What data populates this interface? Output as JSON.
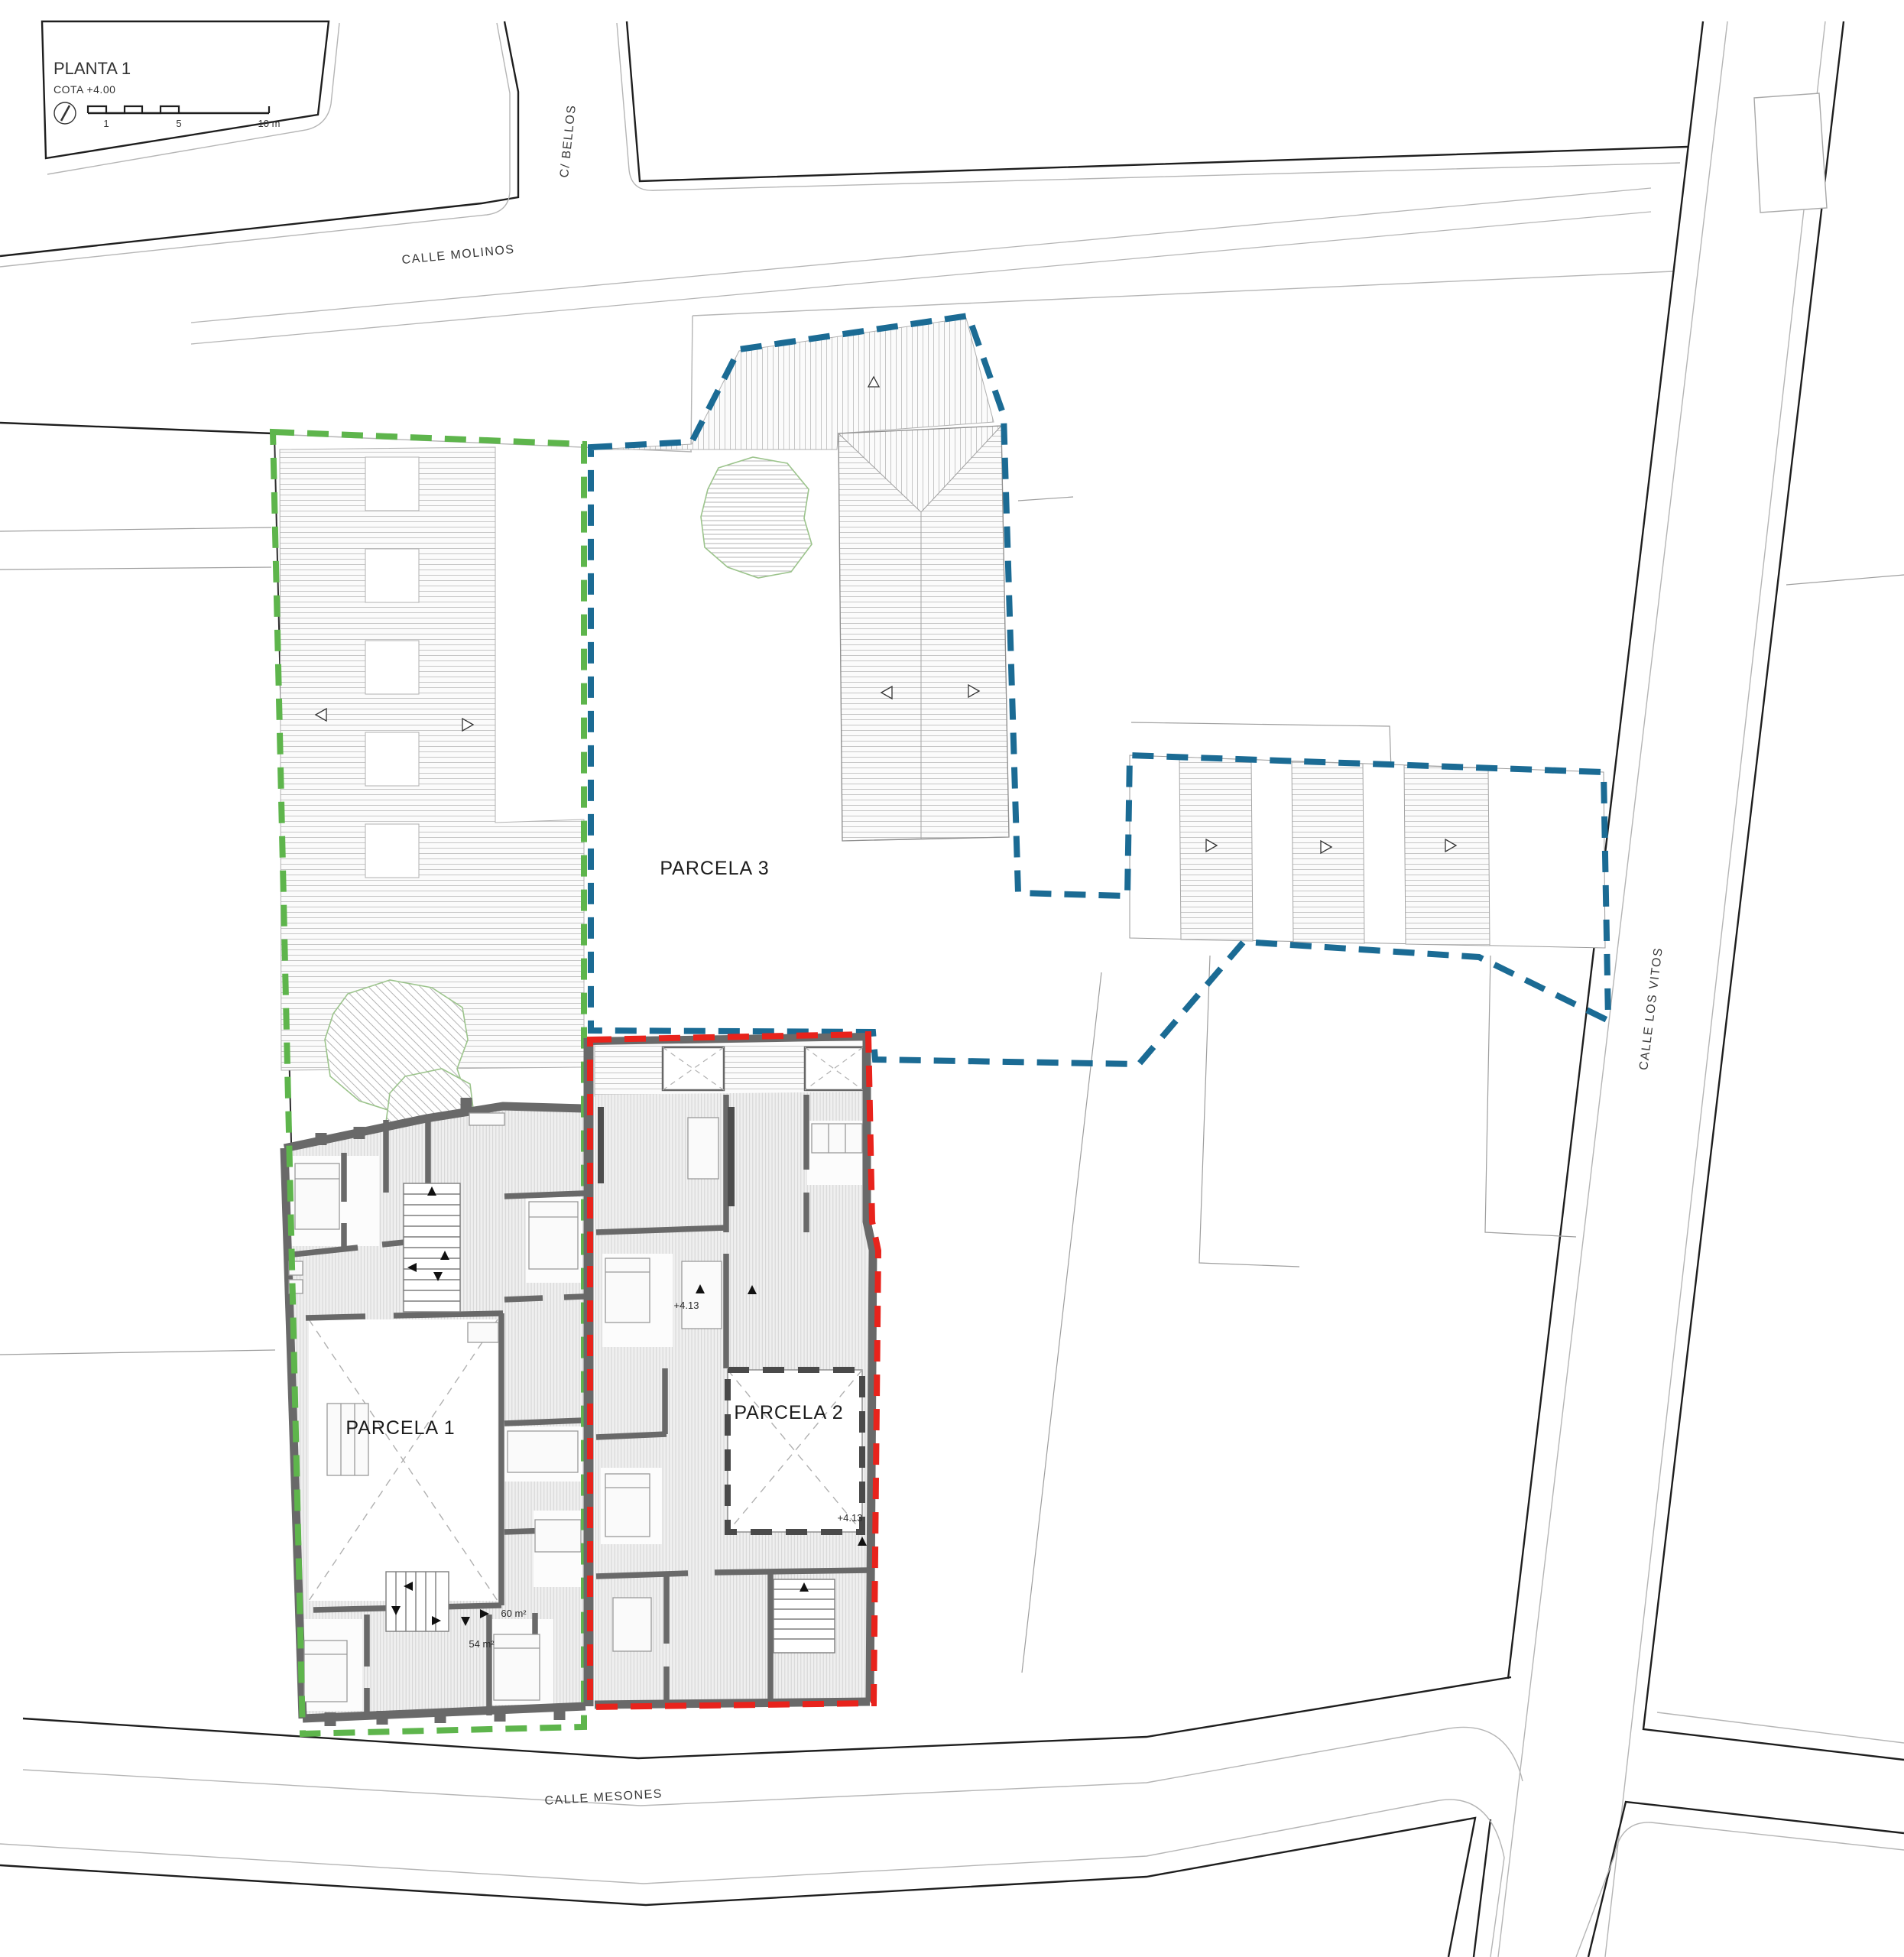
{
  "title": {
    "name": "PLANTA 1",
    "cota": "COTA +4.00"
  },
  "scale_bar": {
    "tick_1": "1",
    "tick_5": "5",
    "tick_10": "10 m"
  },
  "streets": {
    "molinos": "CALLE MOLINOS",
    "bellos": "C/ BELLOS",
    "los_vitos": "CALLE LOS VITOS",
    "mesones": "CALLE MESONES"
  },
  "parcels": {
    "parcela1": {
      "label": "PARCELA 1",
      "boundary_color": "#5eb54c"
    },
    "parcela2": {
      "label": "PARCELA 2",
      "boundary_color": "#e8231c"
    },
    "parcela3": {
      "label": "PARCELA 3",
      "boundary_color": "#1b6b94"
    }
  },
  "annotations": {
    "level_mark_a": "+4.13",
    "level_mark_b": "+4.13",
    "area_60": "60 m²",
    "area_54": "54 m²"
  }
}
